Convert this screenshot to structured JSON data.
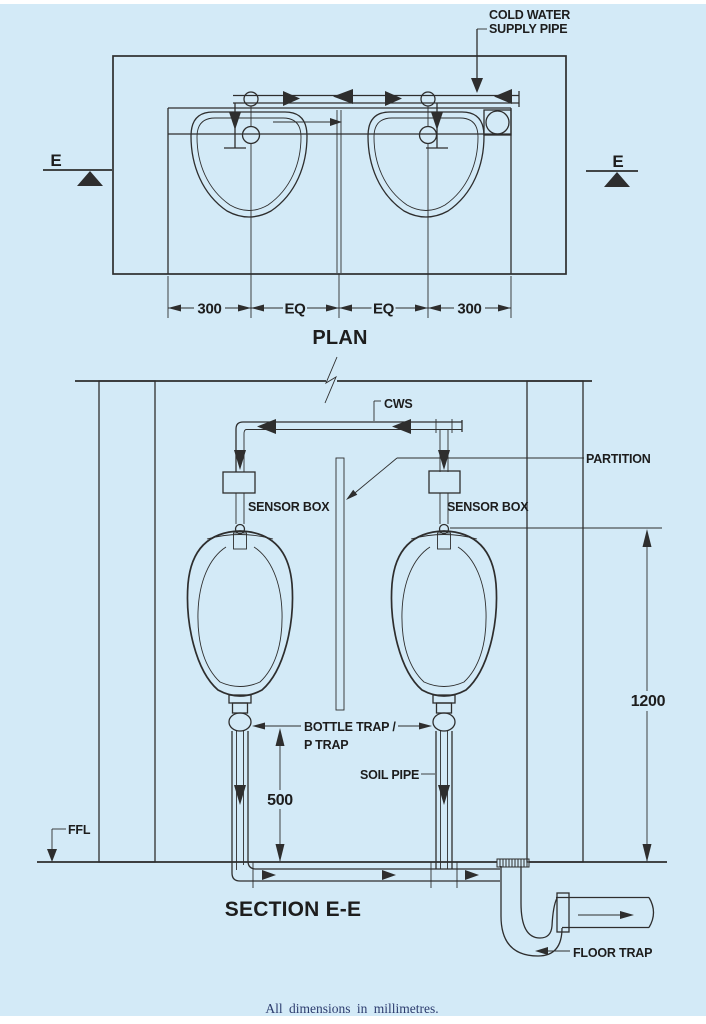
{
  "drawing": {
    "footer": "All dimensions in millimetres.",
    "colors": {
      "background": "#d3eaf7",
      "ink": "#2e2e2e",
      "footer_text": "#2c3c6e"
    }
  },
  "plan": {
    "title": "PLAN",
    "cold_water_label": [
      "COLD WATER",
      "SUPPLY PIPE"
    ],
    "section_marker_left": "E",
    "section_marker_right": "E",
    "dims": {
      "left": "300",
      "eq1": "EQ",
      "eq2": "EQ",
      "right": "300"
    }
  },
  "section": {
    "title": "SECTION E-E",
    "cws": "CWS",
    "partition": "PARTITION",
    "sensor_box_left": "SENSOR BOX",
    "sensor_box_right": "SENSOR BOX",
    "bottle_trap": [
      "BOTTLE TRAP /",
      "P TRAP"
    ],
    "soil_pipe": "SOIL PIPE",
    "ffl": "FFL",
    "floor_trap": "FLOOR TRAP",
    "height_dim": "1200",
    "trap_height_dim": "500"
  }
}
